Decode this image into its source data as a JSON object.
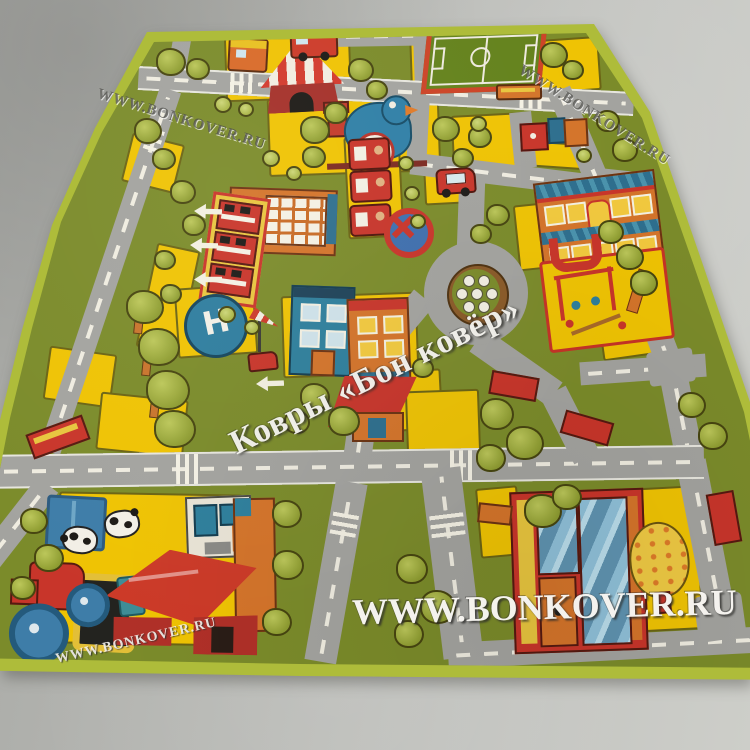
{
  "photo": {
    "subject": "Children's city road play rug photographed on a gray concrete floor",
    "brand": "BONKOVER"
  },
  "watermarks": {
    "top_left": "WWW.BONKOVER.RU",
    "top_right": "WWW.BONKOVER.RU",
    "center": "Ковры «Бон ковёр»",
    "bottom_center": "WWW.BONKOVER.RU",
    "bottom_left": "WWW.BONKOVER.RU"
  },
  "rug": {
    "helipad_letter": "H",
    "palette": {
      "floor": "#b9bab6",
      "rug_border": "#aebc3a",
      "grass": "#7b8b2a",
      "road": "#a3a39f",
      "yellow": "#efc303",
      "red": "#c8352a",
      "orange": "#d4742a",
      "teal": "#2e7f9c",
      "tree_green": "#93a135"
    },
    "landmarks": [
      "circus-tent",
      "soccer-field",
      "toy-train",
      "red-truck",
      "fire-station",
      "fuel-pumps",
      "roundabout-flower",
      "school",
      "playground",
      "helipad",
      "windsock",
      "no-entry-sign",
      "town-houses",
      "farm-field",
      "cows",
      "pig-pen",
      "barn",
      "tractor",
      "pond",
      "shop-building",
      "fruit-tree",
      "benches",
      "trees",
      "road-arrows",
      "crosswalks"
    ]
  }
}
